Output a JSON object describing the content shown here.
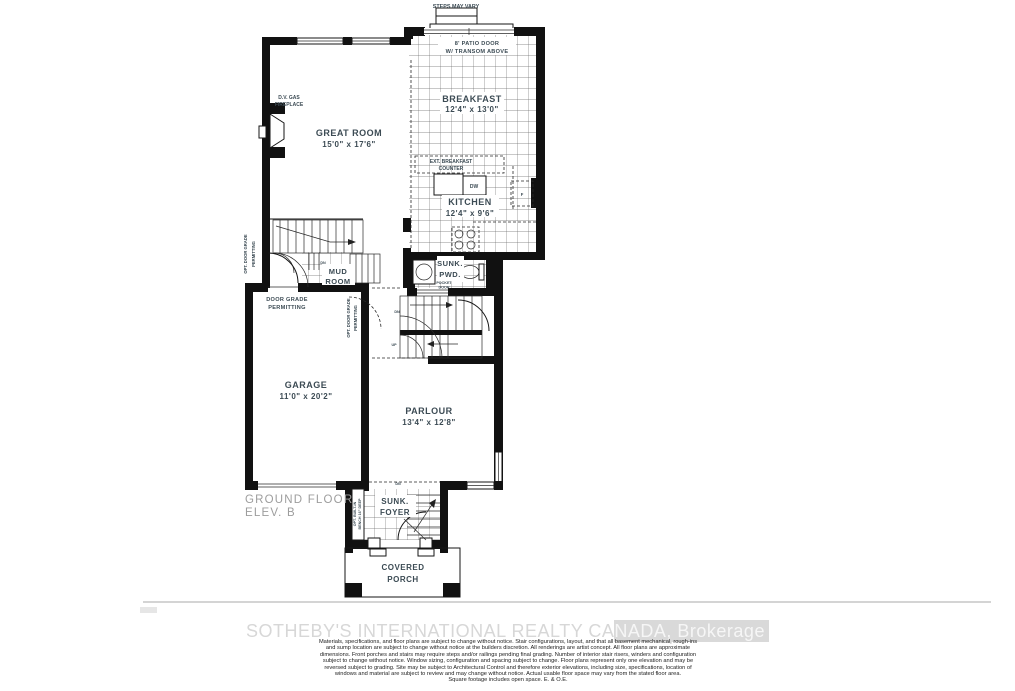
{
  "colors": {
    "wall": "#111111",
    "label": "#3c4b54",
    "muted": "#9d9d9d",
    "tile_line": "#666666",
    "watermark": "#d9d9d9"
  },
  "fp": {
    "steps_note": "STEPS MAY VARY",
    "patio": {
      "l1": "8' PATIO DOOR",
      "l2": "W/ TRANSOM ABOVE"
    },
    "breakfast": {
      "name": "BREAKFAST",
      "dims": "12'4\" x 13'0\""
    },
    "great_room": {
      "name": "GREAT ROOM",
      "dims": "15'0\" x 17'6\""
    },
    "fireplace": {
      "l1": "D.V. GAS",
      "l2": "FIREPLACE"
    },
    "ext_counter": {
      "l1": "EXT. BREAKFAST",
      "l2": "COUNTER"
    },
    "kitchen": {
      "name": "KITCHEN",
      "dims": "12'4\" x 9'6\""
    },
    "appliances": {
      "dishwasher": "DW",
      "fridge": "F"
    },
    "powder": {
      "l1": "SUNK.",
      "l2": "PWD.",
      "pocket1": "POCKET",
      "pocket2": "DOOR"
    },
    "mud_room": {
      "l1": "MUD",
      "l2": "ROOM"
    },
    "garage": {
      "name": "GARAGE",
      "dims": "11'0\" x 20'2\""
    },
    "parlour": {
      "name": "PARLOUR",
      "dims": "13'4\" x 12'8\""
    },
    "foyer": {
      "l1": "SUNK.",
      "l2": "FOYER"
    },
    "porch": {
      "l1": "COVERED",
      "l2": "PORCH"
    },
    "stairs": {
      "dn_mud": "DN",
      "dn_main": "DN",
      "up_main": "UP",
      "dn_foyer": "DN"
    },
    "notes": {
      "door_grade1": "DOOR GRADE",
      "door_grade2": "PERMITTING",
      "opt_left1": "OPT. DOOR GRADE",
      "opt_left2": "PERMITTING",
      "opt_mid1": "OPT. DOOR GRADE",
      "opt_mid2": "PERMITTING",
      "bench1": "OPT. BUILT-IN",
      "bench2": "BENCH 16\" DEEP"
    },
    "floor_label": {
      "l1": "GROUND FLOOR",
      "l2": "ELEV. B"
    }
  },
  "footer": {
    "watermark_left": "SOTHEBY'S INTERNATIONAL REALTY CA",
    "watermark_right": "NADA, Brokerage",
    "disclaimer_lines": [
      "Materials, specifications, and floor plans are subject to change without notice. Stair configurations, layout, and that all basement mechanical, rough-ins",
      "and sump location are subject to change without notice at the builders discretion. All renderings are artist concept. All floor plans are approximate",
      "dimensions. Front porches and stairs may require steps and/or railings pending final grading. Number of interior stair risers, winders and configuration",
      "subject to change without notice. Window sizing, configuration and spacing subject to change. Floor plans represent only one elevation and may be",
      "reversed subject to grading. Site may be subject to Architectural Control and therefore exterior elevations, including size, specifications, location of",
      "windows and material are subject to review and may change without notice. Actual usable floor space may vary from the stated floor area.",
      "Square footage includes open space. E. & O.E."
    ]
  }
}
